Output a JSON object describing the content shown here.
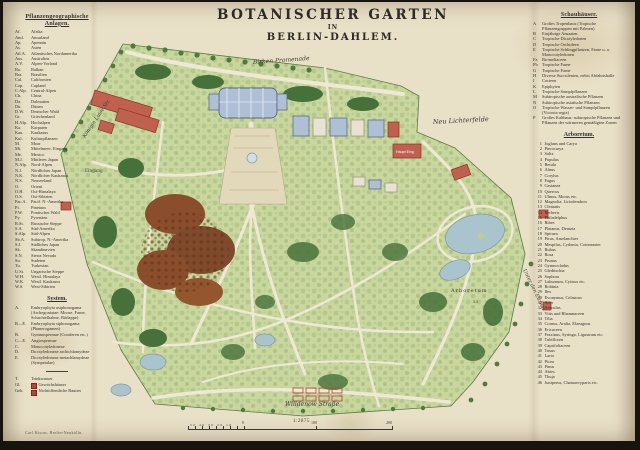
{
  "title": {
    "line1": "BOTANISCHER GARTEN",
    "line2": "IN",
    "line3": "BERLIN-DAHLEM."
  },
  "left_legend": {
    "heading": "Pflanzengeographische Anlagen.",
    "entries": [
      {
        "abbr": "Af.",
        "label": "Afrika"
      },
      {
        "abbr": "Aml.",
        "label": "Amurland"
      },
      {
        "abbr": "Ap.",
        "label": "Apennin"
      },
      {
        "abbr": "As.",
        "label": "Asien"
      },
      {
        "abbr": "Atl.A.",
        "label": "Atlantisches Nordamerika"
      },
      {
        "abbr": "Aus.",
        "label": "Australien"
      },
      {
        "abbr": "A.V.",
        "label": "Alpen-Vorland"
      },
      {
        "abbr": "Ba.",
        "label": "Balkan"
      },
      {
        "abbr": "Bra.",
        "label": "Brasilien"
      },
      {
        "abbr": "Cal.",
        "label": "Californien"
      },
      {
        "abbr": "Cap.",
        "label": "Capland"
      },
      {
        "abbr": "C.Alp.",
        "label": "Central-Alpen"
      },
      {
        "abbr": "Ch.",
        "label": "China"
      },
      {
        "abbr": "Da.",
        "label": "Dalmatien"
      },
      {
        "abbr": "Dü.",
        "label": "Dünen"
      },
      {
        "abbr": "D.W.",
        "label": "Deutscher Wald"
      },
      {
        "abbr": "Gr.",
        "label": "Griechenland"
      },
      {
        "abbr": "H.Alp.",
        "label": "Hochalpen"
      },
      {
        "abbr": "Ka.",
        "label": "Karpaten"
      },
      {
        "abbr": "Kau.",
        "label": "Kaukasus"
      },
      {
        "abbr": "Kul.",
        "label": "Kulturpflanzen"
      },
      {
        "abbr": "M.",
        "label": "Moor"
      },
      {
        "abbr": "Mi.",
        "label": "Mittelmeer; Eingang"
      },
      {
        "abbr": "Me.",
        "label": "Mexico"
      },
      {
        "abbr": "M.J.",
        "label": "Mittleres Japan"
      },
      {
        "abbr": "N.Alp.",
        "label": "Nord-Alpen"
      },
      {
        "abbr": "N.J.",
        "label": "Nördliches Japan"
      },
      {
        "abbr": "N.K.",
        "label": "Nördlicher Kaukasus"
      },
      {
        "abbr": "N.S.",
        "label": "Neuseeland"
      },
      {
        "abbr": "O.",
        "label": "Orient"
      },
      {
        "abbr": "O.H.",
        "label": "Ost-Himalaya"
      },
      {
        "abbr": "O.S.",
        "label": "Ost-Sibirien"
      },
      {
        "abbr": "Pac.A.",
        "label": "Pacif. N.-Amerika"
      },
      {
        "abbr": "Pi.",
        "label": "Pinetum"
      },
      {
        "abbr": "P.W.",
        "label": "Pontischer Wald"
      },
      {
        "abbr": "Py.",
        "label": "Pyrenäen"
      },
      {
        "abbr": "R.St.",
        "label": "Russische Steppe"
      },
      {
        "abbr": "S.A.",
        "label": "Süd-Amerika"
      },
      {
        "abbr": "S.Alp.",
        "label": "Süd-Alpen"
      },
      {
        "abbr": "Sb.A.",
        "label": "Subtrop. N.-Amerika"
      },
      {
        "abbr": "S.J.",
        "label": "Südliches Japan"
      },
      {
        "abbr": "Sk.",
        "label": "Skandinavien"
      },
      {
        "abbr": "S.N.",
        "label": "Sierra Nevada"
      },
      {
        "abbr": "Su.",
        "label": "Sudeten"
      },
      {
        "abbr": "Tu.",
        "label": "Turkestan"
      },
      {
        "abbr": "U.St.",
        "label": "Ungarische Steppe"
      },
      {
        "abbr": "W.H.",
        "label": "Westl. Himalaya"
      },
      {
        "abbr": "W.K.",
        "label": "Westl. Kaukasus"
      },
      {
        "abbr": "W.S.",
        "label": "West-Sibirien"
      }
    ],
    "system_heading": "System.",
    "system_entries": [
      {
        "abbr": "A.",
        "label": "Embryophyta asiphonogama (Archegoniatae: Moose, Farne, Schachtelhalme, Bärlappe)"
      },
      {
        "abbr": "B—E.",
        "label": "Embryophyta siphonogama (Phanerogamen)"
      },
      {
        "abbr": "B.",
        "label": "Gymnospermae (Coniferen etc.)"
      },
      {
        "abbr": "C—E.",
        "label": "Angiospermae"
      },
      {
        "abbr": "C.",
        "label": "Monocotyledoneae"
      },
      {
        "abbr": "D.",
        "label": "Dicotyledoneae archichlamydeae"
      },
      {
        "abbr": "E.",
        "label": "Dicotyledoneae metachlamydeae (Sympetalae)"
      }
    ],
    "symbols": [
      {
        "abbr": "T.",
        "label": "Trinkwasser",
        "swatch": ""
      },
      {
        "abbr": "Gl.",
        "label": "Gewächshäuser",
        "swatch": "#b5443a"
      },
      {
        "abbr": "Geb.",
        "label": "Nichtöffentliche Bauten",
        "swatch": "#b5443a"
      }
    ]
  },
  "right_legend": {
    "schauhaeuser_heading": "Schauhäuser.",
    "schauhaeuser": [
      {
        "k": "A",
        "label": "Großes Tropenhaus (Tropische Pflanzengruppen mit Palmen)"
      },
      {
        "k": "B",
        "label": "Einjährige Ansaaten"
      },
      {
        "k": "C",
        "label": "Tropische Dicotyledonen"
      },
      {
        "k": "D",
        "label": "Tropische Orchideen"
      },
      {
        "k": "E",
        "label": "Tropische Schlingpflanzen, Farne u. a. Monocotyledonen"
      },
      {
        "k": "Fa",
        "label": "Bromeliaceen"
      },
      {
        "k": "Fb",
        "label": "Tropische Farne"
      },
      {
        "k": "G",
        "label": "Tropische Farne"
      },
      {
        "k": "H",
        "label": "Diverse Succulenten, nebst Abfahrtshalle"
      },
      {
        "k": "I",
        "label": "Cacteen"
      },
      {
        "k": "K",
        "label": "Epiphyten"
      },
      {
        "k": "L",
        "label": "Tropische Sumpfpflanzen"
      },
      {
        "k": "M",
        "label": "Subtropische australische Pflanzen"
      },
      {
        "k": "N",
        "label": "Subtropische asiatische Pflanzen"
      },
      {
        "k": "O",
        "label": "Tropische Wasser- und Sumpfpflanzen (Victoria regia)"
      },
      {
        "k": "P",
        "label": "Großes Kalthaus: subtropische Pflanzen und Pflanzen der wärmeren gemäßigten Zonen"
      }
    ],
    "arboretum_heading": "Arboretum.",
    "arboretum": [
      {
        "num": "1",
        "label": "Juglans und Carya"
      },
      {
        "num": "2",
        "label": "Pterocarya"
      },
      {
        "num": "3",
        "label": "Salix"
      },
      {
        "num": "4",
        "label": "Populus"
      },
      {
        "num": "5",
        "label": "Betula"
      },
      {
        "num": "6",
        "label": "Alnus"
      },
      {
        "num": "7",
        "label": "Corylus"
      },
      {
        "num": "8",
        "label": "Fagus"
      },
      {
        "num": "9",
        "label": "Castanea"
      },
      {
        "num": "10",
        "label": "Quercus"
      },
      {
        "num": "11",
        "label": "Ulmus, Morus etc."
      },
      {
        "num": "12",
        "label": "Magnolia, Liriodendron"
      },
      {
        "num": "13",
        "label": "Clematis"
      },
      {
        "num": "14",
        "label": "Berberis"
      },
      {
        "num": "15",
        "label": "Philadelphus"
      },
      {
        "num": "16",
        "label": "Ribes"
      },
      {
        "num": "17",
        "label": "Platanus, Deutzia"
      },
      {
        "num": "18",
        "label": "Spiraea"
      },
      {
        "num": "19",
        "label": "Pirus, Amelanchier"
      },
      {
        "num": "20",
        "label": "Mespilus, Cydonia, Cotoneaster"
      },
      {
        "num": "21",
        "label": "Rubus"
      },
      {
        "num": "22",
        "label": "Rosa"
      },
      {
        "num": "23",
        "label": "Prunus"
      },
      {
        "num": "24",
        "label": "Gymnocladus"
      },
      {
        "num": "25",
        "label": "Gleditschia"
      },
      {
        "num": "26",
        "label": "Sophora"
      },
      {
        "num": "27",
        "label": "Laburnum, Cytisus etc."
      },
      {
        "num": "28",
        "label": "Robinia"
      },
      {
        "num": "29",
        "label": "Ilex"
      },
      {
        "num": "30",
        "label": "Evonymus, Celastrus"
      },
      {
        "num": "31",
        "label": "Acer"
      },
      {
        "num": "32",
        "label": "Aesculus"
      },
      {
        "num": "33",
        "label": "Vitis und Rhamnaceen"
      },
      {
        "num": "34",
        "label": "Tilia"
      },
      {
        "num": "35",
        "label": "Cornus, Aralia, Elaeagnus"
      },
      {
        "num": "36",
        "label": "Ericaceen"
      },
      {
        "num": "37",
        "label": "Fraxinus, Syringa, Ligustrum etc."
      },
      {
        "num": "38",
        "label": "Tubifloren"
      },
      {
        "num": "39",
        "label": "Caprifoliaceen"
      },
      {
        "num": "40",
        "label": "Taxus"
      },
      {
        "num": "41",
        "label": "Larix"
      },
      {
        "num": "42",
        "label": "Picea"
      },
      {
        "num": "43",
        "label": "Pinus"
      },
      {
        "num": "44",
        "label": "Abies"
      },
      {
        "num": "45",
        "label": "Thuja"
      },
      {
        "num": "46",
        "label": "Juniperus, Chamaecyparis etc."
      }
    ]
  },
  "map": {
    "labels": {
      "promenade": "Birken Promenade",
      "koenigin_luise_str": "Königin Luise Str.",
      "eingang": "Eingang",
      "neu_lichterfelde": "Neu Lichterfelde",
      "haupt_eingang": "Haupt Eing.",
      "arboretum": "Arboretum",
      "arboretum_number": "23",
      "unter_den_eichen": "Unter den Eichen",
      "willdenow_strasse": "Willdenow Straße"
    },
    "colors": {
      "paper": "#e9e0c8",
      "garden_green": "#c9d79f",
      "tree_green": "#5d8a47",
      "dark_green": "#3f6b33",
      "building_red": "#c0614f",
      "glasshouse_blue": "#aebfd6",
      "water_blue": "#a9c4cc",
      "system_brown": "#7d4a2c"
    }
  },
  "scale": {
    "ratio": "1:2875",
    "left_numbers": "50 40 30 20 10",
    "marks": [
      "0",
      "100",
      "200"
    ]
  },
  "credit": "Carl Kisow, Berlin-Neukölln."
}
